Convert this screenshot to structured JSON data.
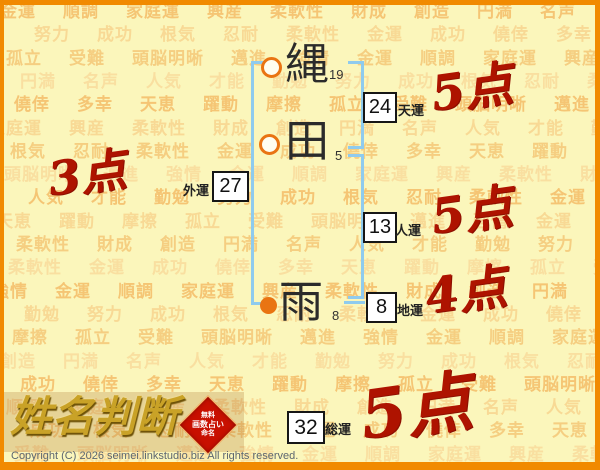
{
  "name_analysis": {
    "characters": [
      {
        "char": "縄",
        "strokes": "19",
        "marker": "open-circle"
      },
      {
        "char": "田",
        "strokes": "5",
        "marker": "open-circle"
      },
      {
        "char": "雨",
        "strokes": "8",
        "marker": "filled-circle"
      }
    ],
    "fortunes": [
      {
        "label": "天運",
        "value": "24",
        "score": "5点"
      },
      {
        "label": "人運",
        "value": "13",
        "score": "5点"
      },
      {
        "label": "地運",
        "value": "8",
        "score": "4点"
      },
      {
        "label": "外運",
        "value": "27",
        "score": "3点"
      },
      {
        "label": "総運",
        "value": "32",
        "score": "5点"
      }
    ]
  },
  "logo": {
    "title": "姓名判断",
    "badge_lines": [
      "無料",
      "画数占い",
      "命名"
    ]
  },
  "footer": {
    "copyright": "Copyright (C) 2026 seimei.linkstudio.biz All rights reserved."
  },
  "background_words": [
    "金運",
    "順調",
    "家庭運",
    "興産",
    "柔軟性",
    "財成",
    "創造",
    "円満",
    "名声",
    "人気",
    "才能",
    "勤勉",
    "努力",
    "成功",
    "根気",
    "忍耐",
    "柔軟性",
    "金運",
    "成功",
    "僥倖",
    "多幸",
    "天恵",
    "躍動",
    "摩擦",
    "孤立",
    "受難",
    "頭脳明晰",
    "邁進",
    "強情"
  ],
  "colors": {
    "border_orange": "#F18A00",
    "page_bg": "#FBF6BB",
    "bracket_blue": "#8FCBEE",
    "marker_orange": "#E97412",
    "score_red": "#AE1300",
    "logo_gold": "#C9A227",
    "badge_red": "#C81000"
  }
}
